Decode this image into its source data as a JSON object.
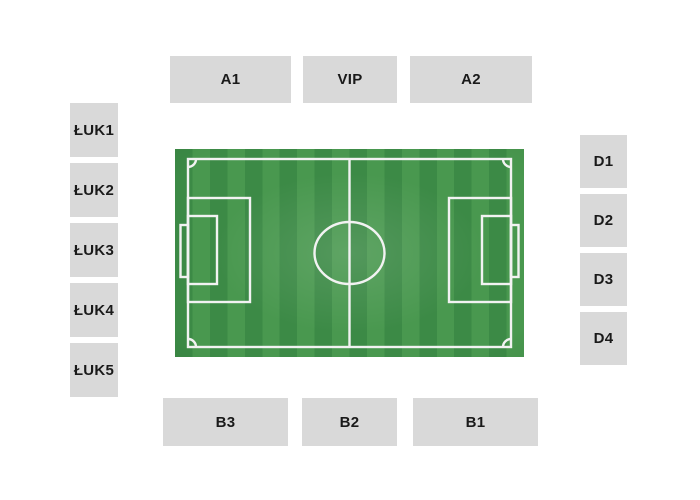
{
  "map_title": "stadium-seating-map",
  "stands": {
    "top": [
      "A1",
      "VIP",
      "A2"
    ],
    "right": [
      "D1",
      "D2",
      "D3",
      "D4"
    ],
    "bottom": [
      "B3",
      "B2",
      "B1"
    ],
    "left": [
      "ŁUK1",
      "ŁUK2",
      "ŁUK3",
      "ŁUK4",
      "ŁUK5"
    ]
  },
  "pitch": {
    "kind": "football-pitch",
    "markings": [
      "boundary",
      "halfway-line",
      "center-circle",
      "penalty-areas",
      "goal-areas",
      "goals",
      "corner-arcs"
    ]
  },
  "colors": {
    "page_background": "#ffffff",
    "stand_background": "#d9d9d9",
    "stand_text": "#1a1a1a",
    "pitch_stripe_dark": "#3c8a46",
    "pitch_stripe_light": "#49984f",
    "pitch_line": "#f2f2f2"
  }
}
